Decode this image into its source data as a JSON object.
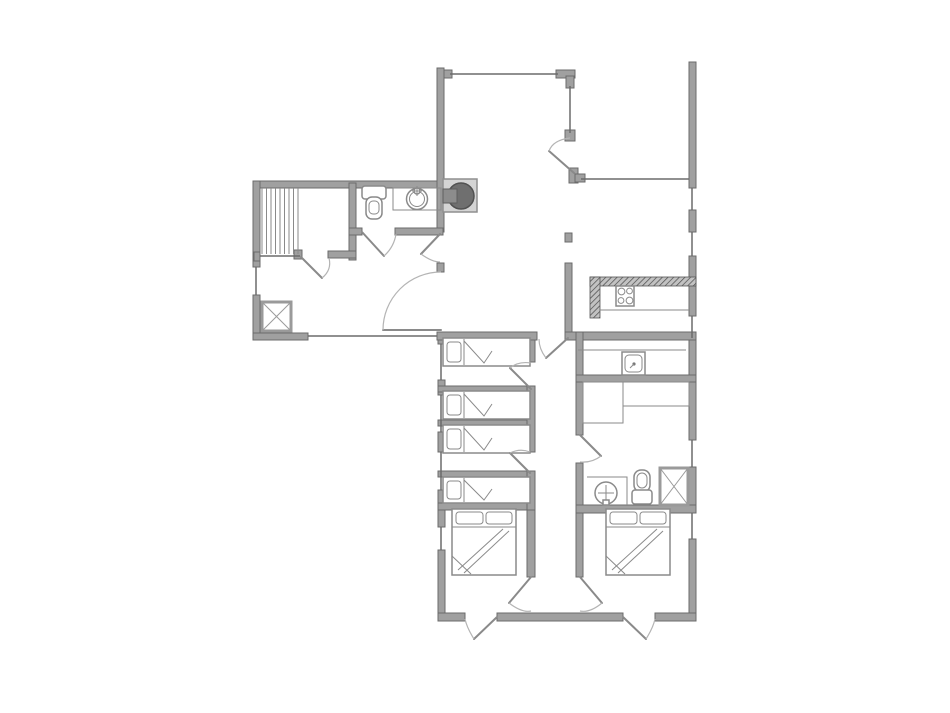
{
  "palette": {
    "background": "#ffffff",
    "wall_fill": "#a0a0a0",
    "wall_edge": "#6b6b6b",
    "fixture_line": "#8a8a8a",
    "door_line": "#8a8a8a",
    "arc_line": "#b4b4b4",
    "hatch_bg": "#c2c2c2",
    "hatch_line": "#4a4a4a",
    "stove_dark": "#6f6f6f",
    "stove_dark_edge": "#515151",
    "stove_body": "#d4d4d4"
  },
  "drawing": {
    "kind": "architectural floor plan",
    "text_labels": [],
    "symbol_legend": [
      {
        "icon": "staircase-icon",
        "shape": "parallel-tread-lines",
        "count": 1
      },
      {
        "icon": "wood-stove-icon",
        "shape": "dark-circle-in-square",
        "count": 1
      },
      {
        "icon": "toilet-icon",
        "shape": "tank-and-bowl",
        "count": 2
      },
      {
        "icon": "round-washbasin-icon",
        "shape": "circle-with-faucet-cross",
        "count": 2
      },
      {
        "icon": "utility-sink-icon",
        "shape": "square-basin-with-drain-dot",
        "count": 1
      },
      {
        "icon": "shower-tray-icon",
        "shape": "square-with-x",
        "count": 2
      },
      {
        "icon": "cooktop-icon",
        "shape": "square-with-four-burners",
        "count": 1
      },
      {
        "icon": "kitchen-counter-icon",
        "shape": "cross-hatched-bar",
        "count": 1
      },
      {
        "icon": "single-bed-icon",
        "shape": "rect-pillow-folded-sheet",
        "count": 4
      },
      {
        "icon": "double-bed-icon",
        "shape": "rect-two-pillows-folded-sheet",
        "count": 2
      },
      {
        "icon": "door-swing-icon",
        "shape": "leaf-with-quarter-arc",
        "count": 13
      },
      {
        "icon": "window-icon",
        "shape": "thin-line-in-wall-gap",
        "count": 14
      },
      {
        "icon": "wardrobe-counter-icon",
        "shape": "thin-outline-rectangles",
        "count": 3
      }
    ]
  }
}
